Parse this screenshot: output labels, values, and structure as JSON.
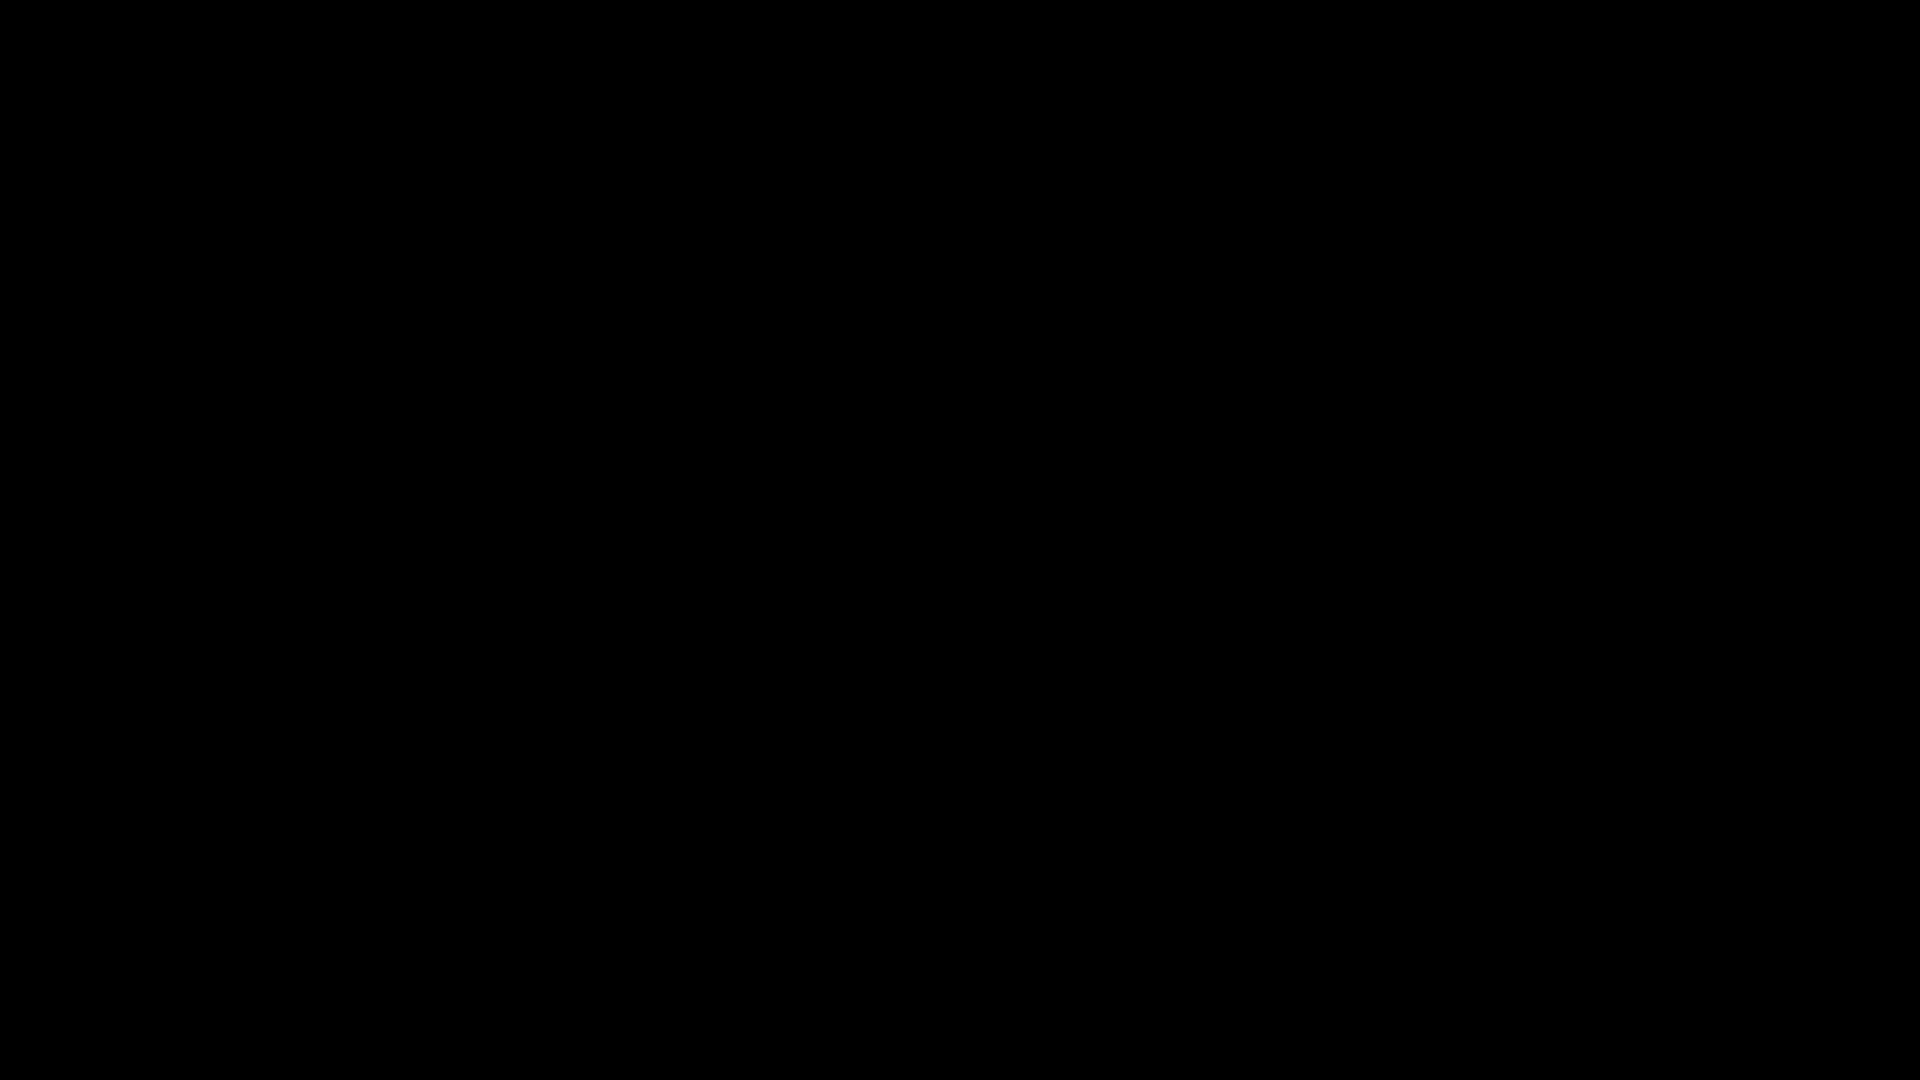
{
  "meta": {
    "app_title": "factory-level-screenshot",
    "viewport": {
      "w": 1920,
      "h": 1080
    }
  },
  "colors": {
    "black": "#000000",
    "green_wall": "#1d2c23",
    "green_stripe": "#162219",
    "pipe": "#968cb0",
    "pipe_hi": "#cfc6e0",
    "pipe_out": "#241f30",
    "pipe_coupling": "#887da3",
    "pipe_dark": "#3d3d49",
    "pipe_shadow": "#262a26",
    "pipe_left": "#1b1822",
    "floor": "#9d9aa8",
    "floor_trim": "#8e8a9b",
    "trim_red": "#9c5146",
    "hazard_yellow": "#d6c05c",
    "marking_yellow": "#d9bd55",
    "dark_room": "#1f1e23",
    "dark_column": "#141318",
    "orb_red_core": "#d4625c",
    "orb_red_ring": "#45384f",
    "orb_gold_core": "#d9ab4e",
    "orb_gold_ring": "#93803f",
    "player_body": "#f5c742",
    "player_outline": "#7a4f12",
    "light_body": "#fffdf0",
    "light_cap": "#d8b84a",
    "glow": "#fff4c8",
    "screen_blue": "#aebbe8",
    "screen_glyph": "#e6ecff",
    "led_green": "#55c05c",
    "led_red": "#d85348",
    "laser_red": "#e23b2e",
    "truss": "#343848",
    "gear_light": "#565d6e",
    "drill_body": "#23202e",
    "drill_band": "#b85057",
    "drill_trim": "#b89a50",
    "tan_panel": "#857a60",
    "fan_blade": "#4d4766"
  },
  "player": {
    "x": 727,
    "y": 286,
    "kind": "spiky-star-creature",
    "eyes": 2
  },
  "orbs": [
    {
      "type": "red",
      "x": 175,
      "y": 106,
      "blades": 180
    },
    {
      "type": "red",
      "x": 742,
      "y": 347,
      "blades": 195
    },
    {
      "type": "red",
      "x": 1110,
      "y": 390,
      "blades": 215
    },
    {
      "type": "red",
      "x": 1460,
      "y": 295,
      "blades": 180
    },
    {
      "type": "red",
      "x": 177,
      "y": 508,
      "blades": 180
    },
    {
      "type": "red",
      "x": 298,
      "y": 732,
      "blades": 180
    },
    {
      "type": "gold",
      "x": 387,
      "y": 141,
      "blades": 0
    },
    {
      "type": "gold",
      "x": 992,
      "y": 217,
      "blades": 0
    },
    {
      "type": "gold",
      "x": 630,
      "y": 546,
      "blades": 15
    },
    {
      "type": "gold",
      "x": 1215,
      "y": 565,
      "blades": 0
    },
    {
      "type": "gold",
      "x": 998,
      "y": 722,
      "blades": 230
    },
    {
      "type": "gold",
      "x": 175,
      "y": 772,
      "blades": 10
    },
    {
      "type": "gold",
      "x": 1098,
      "y": 1046,
      "blades": 0,
      "r": 22
    }
  ],
  "lights": [
    [
      552,
      437
    ],
    [
      305,
      556
    ],
    [
      305,
      825
    ],
    [
      915,
      380
    ],
    [
      1340,
      698
    ],
    [
      1340,
      855
    ],
    [
      748,
      925
    ]
  ],
  "cone_lights": [
    [
      1750,
      820
    ],
    [
      1750,
      986
    ]
  ],
  "pipes_purple": [
    [
      [
        96,
        57
      ],
      [
        693,
        57
      ],
      [
        693,
        125
      ],
      [
        885,
        125
      ],
      [
        885,
        57
      ],
      [
        1150,
        57
      ],
      [
        1150,
        620
      ],
      [
        1468,
        620
      ]
    ],
    [
      [
        250,
        287
      ],
      [
        1150,
        287
      ]
    ],
    [
      [
        545,
        523
      ],
      [
        1150,
        523
      ]
    ],
    [
      [
        558,
        57
      ],
      [
        558,
        523
      ]
    ],
    [
      [
        700,
        287
      ],
      [
        700,
        523
      ]
    ],
    [
      [
        212,
        40
      ],
      [
        212,
        462
      ],
      [
        448,
        462
      ],
      [
        448,
        598
      ],
      [
        690,
        598
      ]
    ],
    [
      [
        236,
        455
      ],
      [
        236,
        918
      ]
    ],
    [
      [
        236,
        663
      ],
      [
        360,
        663
      ],
      [
        360,
        795
      ],
      [
        808,
        795
      ],
      [
        808,
        663
      ],
      [
        1055,
        663
      ],
      [
        1055,
        884
      ]
    ]
  ],
  "couplings_h": [
    [
      170,
      57
    ],
    [
      345,
      57
    ],
    [
      520,
      57
    ],
    [
      620,
      57
    ],
    [
      950,
      57
    ],
    [
      1070,
      57
    ],
    [
      762,
      125
    ],
    [
      830,
      125
    ],
    [
      320,
      287
    ],
    [
      465,
      287
    ],
    [
      610,
      287
    ],
    [
      860,
      287
    ],
    [
      1000,
      287
    ],
    [
      1090,
      287
    ],
    [
      620,
      523
    ],
    [
      740,
      523
    ],
    [
      860,
      523
    ],
    [
      1000,
      523
    ],
    [
      1090,
      523
    ],
    [
      300,
      462
    ],
    [
      390,
      462
    ],
    [
      540,
      598
    ],
    [
      645,
      598
    ],
    [
      1240,
      620
    ],
    [
      1340,
      620
    ],
    [
      1435,
      620
    ],
    [
      310,
      663
    ],
    [
      500,
      795
    ],
    [
      650,
      795
    ],
    [
      900,
      663
    ],
    [
      980,
      663
    ]
  ],
  "couplings_v": [
    [
      693,
      92
    ],
    [
      885,
      92
    ],
    [
      1150,
      140
    ],
    [
      1150,
      230
    ],
    [
      1150,
      350
    ],
    [
      1150,
      430
    ],
    [
      1150,
      560
    ],
    [
      558,
      130
    ],
    [
      558,
      225
    ],
    [
      558,
      330
    ],
    [
      558,
      440
    ],
    [
      700,
      390
    ],
    [
      700,
      465
    ],
    [
      212,
      120
    ],
    [
      212,
      230
    ],
    [
      212,
      330
    ],
    [
      448,
      540
    ],
    [
      236,
      520
    ],
    [
      236,
      600
    ],
    [
      236,
      750
    ],
    [
      236,
      840
    ],
    [
      360,
      740
    ],
    [
      808,
      720
    ],
    [
      1055,
      700
    ],
    [
      1055,
      760
    ],
    [
      1055,
      840
    ]
  ],
  "pipe_caps": [
    [
      690,
      598,
      "h"
    ],
    [
      1055,
      888,
      "v"
    ]
  ],
  "pipes_dark": [
    {
      "pts": [
        [
          1440,
          775
        ],
        [
          1218,
          775
        ],
        [
          1218,
          905
        ]
      ],
      "w": 30
    },
    {
      "pts": [
        [
          1176,
          840
        ],
        [
          880,
          840
        ],
        [
          880,
          905
        ]
      ],
      "w": 28
    },
    {
      "pts": [
        [
          620,
          918
        ],
        [
          1285,
          918
        ]
      ],
      "w": 24
    }
  ],
  "dark_couplings": [
    [
      1300,
      775,
      "h"
    ],
    [
      1392,
      775,
      "h"
    ],
    [
      1218,
      845,
      "v"
    ],
    [
      960,
      840,
      "h"
    ],
    [
      1070,
      840,
      "h"
    ],
    [
      660,
      918,
      "h"
    ],
    [
      745,
      918,
      "h"
    ],
    [
      835,
      918,
      "h"
    ],
    [
      925,
      918,
      "h"
    ],
    [
      1015,
      918,
      "h"
    ],
    [
      1105,
      918,
      "h"
    ],
    [
      1195,
      918,
      "h"
    ],
    [
      1268,
      918,
      "h"
    ]
  ],
  "pipes_shadow": [
    {
      "pts": [
        [
          822,
          788
        ],
        [
          962,
          788
        ]
      ],
      "w": 20
    }
  ],
  "pipes_left": [
    {
      "pts": [
        [
          92,
          70
        ],
        [
          92,
          655
        ]
      ],
      "w": 20
    },
    {
      "pts": [
        [
          113,
          72
        ],
        [
          113,
          650
        ]
      ],
      "w": 13
    },
    {
      "pts": [
        [
          566,
          45
        ],
        [
          566,
          198
        ],
        [
          508,
          198
        ]
      ],
      "w": 18
    }
  ],
  "u_handle": {
    "x1": 506,
    "x2": 550,
    "ytop": 182,
    "ybot": 232
  },
  "silhouettes": {
    "main_pipe": [
      [
        1516,
        496
      ],
      [
        1516,
        953
      ],
      [
        1277,
        953
      ],
      [
        1277,
        1085
      ]
    ],
    "main_pipe_w": 88,
    "nub": [
      1468,
      716
    ],
    "drill_left": [
      [
        70,
        641
      ],
      [
        112,
        628
      ],
      [
        148,
        637
      ],
      [
        184,
        629
      ],
      [
        214,
        642
      ],
      [
        228,
        651
      ],
      [
        214,
        660
      ],
      [
        184,
        671
      ],
      [
        148,
        665
      ],
      [
        112,
        673
      ],
      [
        70,
        661
      ]
    ],
    "bottom_mass": [
      [
        430,
        1080
      ],
      [
        430,
        975
      ],
      [
        520,
        948
      ],
      [
        600,
        970
      ],
      [
        648,
        938
      ],
      [
        700,
        952
      ],
      [
        760,
        975
      ],
      [
        820,
        950
      ],
      [
        866,
        930
      ],
      [
        866,
        884
      ],
      [
        902,
        862
      ],
      [
        938,
        884
      ],
      [
        938,
        1080
      ]
    ],
    "bottom_blocks": [
      [
        975,
        952,
        62,
        128
      ],
      [
        0,
        908,
        230,
        172
      ]
    ]
  },
  "trusses_v": [
    {
      "x": 1243,
      "y1": 42,
      "y2": 1080,
      "w": 30
    },
    {
      "x": 1413,
      "y1": 42,
      "y2": 1080,
      "w": 30
    },
    {
      "x": 296,
      "y1": 942,
      "y2": 1080,
      "w": 36
    },
    {
      "x": 600,
      "y1": 898,
      "y2": 1080,
      "w": 46
    }
  ],
  "trusses_h": [
    {
      "y": 912,
      "x1": 228,
      "x2": 706,
      "h": 34
    },
    {
      "y": 1050,
      "x1": 228,
      "x2": 706,
      "h": 30
    }
  ],
  "ladders": [
    [
      310,
      45,
      27,
      195
    ],
    [
      634,
      77,
      27,
      156
    ]
  ],
  "chimney_clusters": [
    {
      "tone": "dark",
      "items": [
        [
          775,
          405,
          18,
          105
        ],
        [
          818,
          405,
          18,
          105
        ],
        [
          755,
          462,
          13,
          48
        ],
        [
          802,
          460,
          15,
          50
        ]
      ]
    },
    {
      "tone": "light",
      "items": [
        [
          506,
          490,
          15,
          106
        ],
        [
          528,
          486,
          15,
          110
        ],
        [
          552,
          492,
          15,
          104
        ],
        [
          576,
          488,
          15,
          108
        ]
      ]
    },
    {
      "tone": "mid",
      "items": [
        [
          612,
          812,
          15,
          104
        ],
        [
          636,
          806,
          15,
          110
        ],
        [
          660,
          815,
          15,
          101
        ],
        [
          684,
          810,
          15,
          106
        ]
      ]
    }
  ],
  "gears": [
    [
      1398,
      150,
      36,
      "light"
    ],
    [
      1332,
      308,
      24,
      "mid"
    ],
    [
      1253,
      255,
      26,
      "dark"
    ],
    [
      1300,
      490,
      42,
      "mid"
    ],
    [
      1408,
      562,
      78,
      "light"
    ],
    [
      1130,
      1035,
      55,
      "green"
    ],
    [
      920,
      1030,
      40,
      "green"
    ],
    [
      1250,
      1012,
      22,
      "green"
    ]
  ],
  "fan": {
    "cx": 1670,
    "cy": 145,
    "r": 105,
    "spokes": 12
  },
  "fan_boxes": [
    [
      1302,
      55,
      74,
      72
    ],
    [
      1310,
      224,
      40,
      38
    ]
  ],
  "vent_dark_room": {
    "grate": [
      1002,
      303,
      80,
      72
    ],
    "bar_v": [
      981,
      296,
      14,
      88
    ],
    "bar_h": [
      981,
      378,
      110,
      13
    ]
  },
  "vent_top": {
    "grate": [
      732,
      36,
      110,
      70
    ],
    "brackets": [
      [
        728,
        84
      ],
      [
        820,
        84
      ]
    ]
  },
  "monitors": [
    {
      "id": "blueprint-large",
      "x": 418,
      "y": 953,
      "w": 128,
      "h": 88,
      "screen": "blueprint"
    },
    {
      "id": "small-dark",
      "x": 1178,
      "y": 1022,
      "w": 54,
      "h": 56,
      "screen": "dark"
    },
    {
      "id": "blueprint-small",
      "x": 1246,
      "y": 1032,
      "w": 124,
      "h": 48,
      "screen": "blueprint"
    },
    {
      "id": "dark-right",
      "x": 1372,
      "y": 1020,
      "w": 66,
      "h": 60,
      "screen": "dark"
    }
  ],
  "keypad": {
    "x": 286,
    "y": 216,
    "w": 58,
    "h": 54,
    "buttons": [
      "red",
      "green",
      "green",
      "green",
      "red",
      "green"
    ]
  },
  "turrets": [
    {
      "x": 377,
      "y": 258,
      "r": 15,
      "barrel": null
    },
    {
      "x": 497,
      "y": 311,
      "r": 13,
      "barrel": null
    },
    {
      "x": 300,
      "y": 474,
      "r": 15,
      "barrel": -25
    },
    {
      "x": 303,
      "y": 891,
      "r": 14,
      "barrel": 210
    },
    {
      "x": 912,
      "y": 494,
      "r": 15,
      "barrel": 230
    }
  ],
  "laser_dashes": [
    [
      432,
      308
    ],
    [
      452,
      308
    ],
    [
      472,
      308
    ]
  ],
  "drill_item": {
    "outline": [
      [
        1590,
        846
      ],
      [
        1612,
        820
      ],
      [
        1626,
        832
      ],
      [
        1642,
        816
      ],
      [
        1658,
        830
      ],
      [
        1674,
        814
      ],
      [
        1692,
        828
      ],
      [
        1706,
        818
      ],
      [
        1718,
        830
      ],
      [
        1722,
        836
      ],
      [
        1744,
        836
      ],
      [
        1744,
        862
      ],
      [
        1722,
        862
      ],
      [
        1714,
        868
      ],
      [
        1700,
        878
      ],
      [
        1686,
        866
      ],
      [
        1668,
        880
      ],
      [
        1652,
        866
      ],
      [
        1634,
        879
      ],
      [
        1620,
        864
      ],
      [
        1606,
        872
      ]
    ],
    "band": [
      [
        1640,
        820
      ],
      [
        1670,
        818
      ],
      [
        1650,
        874
      ],
      [
        1620,
        872
      ]
    ]
  },
  "crates": [
    [
      1598,
      906,
      78,
      74
    ],
    [
      1680,
      906,
      76,
      74
    ],
    [
      1758,
      906,
      44,
      74
    ]
  ],
  "hazard_bar": [
    1233,
    1010,
    42,
    15
  ],
  "floors": {
    "main": [
      [
        118,
        250
      ],
      [
        670,
        250
      ],
      [
        700,
        272
      ],
      [
        700,
        598
      ],
      [
        448,
        598
      ],
      [
        448,
        910
      ],
      [
        118,
        910
      ]
    ],
    "c": [
      [
        1178,
        662
      ],
      [
        1216,
        640
      ],
      [
        1532,
        640
      ],
      [
        1532,
        936
      ],
      [
        1178,
        936
      ]
    ],
    "drill_room": [
      1556,
      772,
      246,
      248
    ],
    "tile_wall": [
      392,
      946,
      180,
      134
    ],
    "machinery": [
      880,
      985,
      565,
      95
    ],
    "ledge_blocks": [
      [
        1152,
        1032,
        24,
        44
      ]
    ]
  },
  "hazard": {
    "x": 134,
    "w": 48,
    "y1": 268,
    "y2": 898,
    "line_x": 187,
    "line_w": 11
  },
  "x_marking": {
    "x1": 544,
    "y1": 312,
    "x2": 684,
    "y2": 448,
    "stroke": 19,
    "chev": 42
  },
  "arrow": [
    [
      646,
      258
    ],
    [
      646,
      290
    ],
    [
      676,
      274
    ]
  ],
  "regions": {
    "green_main": [
      105,
      40,
      1060,
      885
    ],
    "green_strip": [
      1162,
      40,
      80,
      600
    ],
    "stone": [
      105,
      40,
      575,
      210
    ],
    "dark_room": [
      700,
      287,
      465,
      240
    ],
    "dark_column": [
      1242,
      40,
      298,
      600
    ],
    "column_bar": [
      1287,
      128,
      130,
      14
    ],
    "fan_panel": [
      1540,
      35,
      260,
      235
    ],
    "rib_strip": [
      1800,
      35,
      52,
      220
    ],
    "tan_panel": [
      1852,
      35,
      68,
      217
    ],
    "ledge": [
      1540,
      253,
      380,
      20
    ],
    "beam_h": [
      1512,
      290,
      408,
      34
    ],
    "beam_v": [
      1512,
      290,
      36,
      254
    ],
    "door_panels": [
      1508,
      470,
      62,
      460
    ],
    "right_wall": [
      1792,
      640,
      52,
      440
    ],
    "rail": [
      100,
      26,
      1820,
      14
    ],
    "left_wall": [
      78,
      40,
      42,
      870
    ],
    "edge_blocks": [
      112,
      250,
      12,
      660
    ]
  },
  "seams": {
    "v": [
      [
        845,
        45,
        860
      ],
      [
        985,
        45,
        860
      ],
      [
        1125,
        45,
        860
      ]
    ],
    "h": [
      [
        105,
        222,
        1060
      ],
      [
        105,
        505,
        1060
      ],
      [
        105,
        690,
        1060
      ],
      [
        105,
        838,
        1060
      ]
    ]
  }
}
